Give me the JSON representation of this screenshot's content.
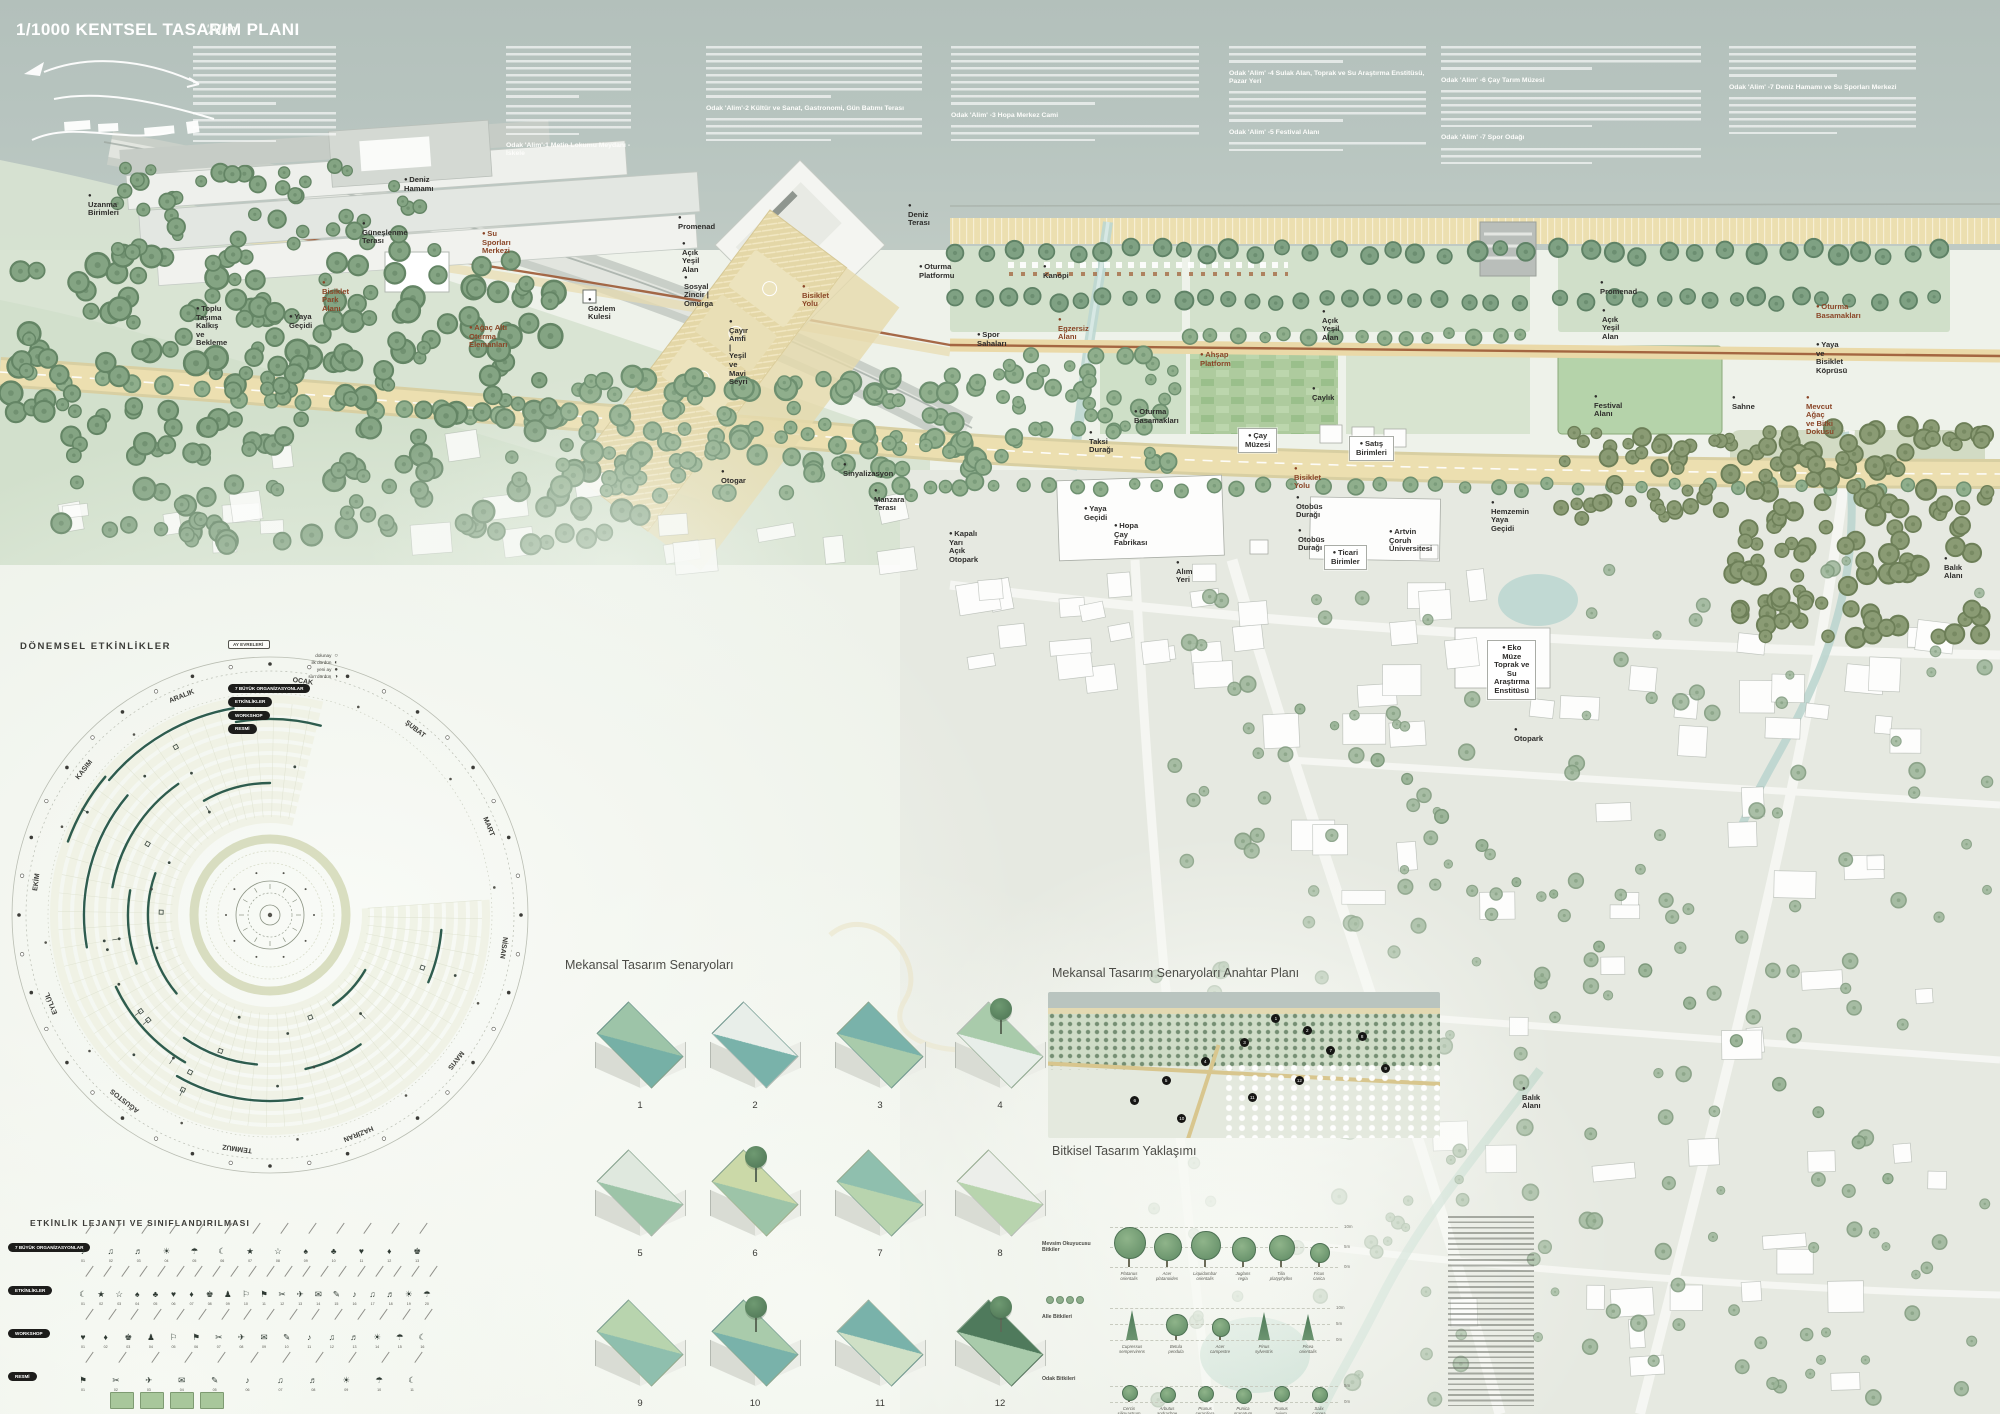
{
  "header": {
    "title": "1/1000 KENTSEL TASARIM PLANI",
    "subtitle": "'Alim'",
    "columns": [
      {
        "x": 207,
        "w": 143,
        "segments": [
          [
            "p",
            8
          ],
          [
            "p",
            4
          ]
        ]
      },
      {
        "x": 520,
        "w": 125,
        "segments": [
          [
            "p",
            7
          ],
          [
            "p",
            4
          ],
          [
            "h",
            "Odak 'Alim'-1 Metin Lokumu Meydanı - İskele"
          ]
        ]
      },
      {
        "x": 720,
        "w": 216,
        "segments": [
          [
            "p",
            7
          ],
          [
            "h",
            "Odak 'Alim'-2 Kültür ve Sanat, Gastronomi, Gün Batımı Terası"
          ],
          [
            "p",
            3
          ]
        ]
      },
      {
        "x": 965,
        "w": 248,
        "segments": [
          [
            "p",
            8
          ],
          [
            "h",
            "Odak 'Alim' -3 Hopa Merkez Cami"
          ],
          [
            "p",
            2
          ]
        ]
      },
      {
        "x": 1243,
        "w": 197,
        "segments": [
          [
            "p",
            2
          ],
          [
            "h",
            "Odak 'Alim' -4 Sulak Alan, Toprak ve Su Araştırma Enstitüsü, Pazar Yeri"
          ],
          [
            "p",
            4
          ],
          [
            "h",
            "Odak 'Alim' -5 Festival Alanı"
          ],
          [
            "p",
            1
          ]
        ]
      },
      {
        "x": 1455,
        "w": 260,
        "segments": [
          [
            "p",
            3
          ],
          [
            "h",
            "Odak 'Alim' -6 Çay Tarım Müzesi"
          ],
          [
            "p",
            5
          ],
          [
            "h",
            "Odak 'Alim' -7 Spor Odağı"
          ],
          [
            "p",
            2
          ]
        ]
      },
      {
        "x": 1743,
        "w": 187,
        "segments": [
          [
            "p",
            4
          ],
          [
            "h",
            "Odak 'Alim' -7 Deniz Hamamı ve Su Sporları Merkezi"
          ],
          [
            "p",
            5
          ]
        ]
      }
    ]
  },
  "map": {
    "labels": [
      {
        "t": "Deniz Hamamı",
        "x": 404,
        "y": 176
      },
      {
        "t": "Güneşlenme Terası",
        "x": 362,
        "y": 220
      },
      {
        "t": "Su Sporları Merkezi",
        "x": 482,
        "y": 230,
        "c": "b"
      },
      {
        "t": "Uzanma Birimleri",
        "x": 88,
        "y": 192
      },
      {
        "t": "Toplu Taşıma\nKalkış ve Bekleme",
        "x": 196,
        "y": 305
      },
      {
        "t": "Yaya\nGeçidi",
        "x": 289,
        "y": 313
      },
      {
        "t": "Bisiklet\nPark Alanı",
        "x": 322,
        "y": 279,
        "c": "b"
      },
      {
        "t": "Gözlem Kulesi",
        "x": 588,
        "y": 296
      },
      {
        "t": "Promenad",
        "x": 678,
        "y": 214
      },
      {
        "t": "Açık Yeşil Alan",
        "x": 682,
        "y": 240
      },
      {
        "t": "Sosyal Zincir | Omurga",
        "x": 684,
        "y": 274
      },
      {
        "t": "Bisiklet Yolu",
        "x": 802,
        "y": 283,
        "c": "b"
      },
      {
        "t": "Çayır Amfi | Yeşil ve Mavi Seyri",
        "x": 729,
        "y": 318
      },
      {
        "t": "Ağaç Altı Oturma Elemanları",
        "x": 469,
        "y": 324,
        "c": "b"
      },
      {
        "t": "Deniz Terası",
        "x": 908,
        "y": 202
      },
      {
        "t": "Oturma Platformu",
        "x": 919,
        "y": 263
      },
      {
        "t": "Kanopi",
        "x": 1043,
        "y": 263
      },
      {
        "t": "Egzersiz Alanı",
        "x": 1058,
        "y": 316,
        "c": "b"
      },
      {
        "t": "Spor Sahaları",
        "x": 977,
        "y": 331
      },
      {
        "t": "Ahşap Platform",
        "x": 1200,
        "y": 351,
        "c": "b"
      },
      {
        "t": "Oturma\nBasamakları",
        "x": 1134,
        "y": 408
      },
      {
        "t": "Açık Yeşil Alan",
        "x": 1322,
        "y": 308
      },
      {
        "t": "Çaylık",
        "x": 1312,
        "y": 385
      },
      {
        "t": "Promenad",
        "x": 1600,
        "y": 279
      },
      {
        "t": "Açık Yeşil Alan",
        "x": 1602,
        "y": 307
      },
      {
        "t": "Festival Alanı",
        "x": 1594,
        "y": 393
      },
      {
        "t": "Oturma Basamakları",
        "x": 1816,
        "y": 303,
        "c": "b"
      },
      {
        "t": "Yaya ve Bisiklet\nKöprüsü",
        "x": 1816,
        "y": 341
      },
      {
        "t": "Sahne",
        "x": 1732,
        "y": 394
      },
      {
        "t": "Mevcut Ağaç ve Bitki Dokusu",
        "x": 1806,
        "y": 394,
        "c": "b"
      },
      {
        "t": "Bisiklet Yolu",
        "x": 1294,
        "y": 465,
        "c": "b"
      },
      {
        "t": "Otobüs Durağı",
        "x": 1296,
        "y": 494
      },
      {
        "t": "Otobüs Durağı",
        "x": 1298,
        "y": 527
      },
      {
        "t": "Hemzemin\nYaya Geçidi",
        "x": 1491,
        "y": 499
      },
      {
        "t": "Ticari Birimler",
        "x": 1324,
        "y": 545,
        "box": 1
      },
      {
        "t": "Çay Müzesi",
        "x": 1238,
        "y": 428,
        "box": 1
      },
      {
        "t": "Satış Birimleri",
        "x": 1349,
        "y": 436,
        "box": 1
      },
      {
        "t": "Otogar",
        "x": 721,
        "y": 468
      },
      {
        "t": "Sinyalizasyon",
        "x": 843,
        "y": 461
      },
      {
        "t": "Yaya\nGeçidi",
        "x": 1084,
        "y": 505
      },
      {
        "t": "Kapalı Yarı\nAçık Otopark",
        "x": 949,
        "y": 530
      },
      {
        "t": "Alım Yeri",
        "x": 1176,
        "y": 559
      },
      {
        "t": "Hopa Çay Fabrikası",
        "x": 1114,
        "y": 522
      },
      {
        "t": "Artvin Çoruh Üniversitesi",
        "x": 1389,
        "y": 528
      },
      {
        "t": "Balık Alanı",
        "x": 1944,
        "y": 555
      },
      {
        "t": "Eko Müze\nToprak ve Su\nAraştırma Enstitüsü",
        "x": 1487,
        "y": 640,
        "box": 1
      },
      {
        "t": "Otopark",
        "x": 1514,
        "y": 726
      },
      {
        "t": "Manzara Terası",
        "x": 874,
        "y": 487
      },
      {
        "t": "Taksi Durağı",
        "x": 1089,
        "y": 429
      },
      {
        "t": "Balık Alanı",
        "x": 1522,
        "y": 1085
      }
    ]
  },
  "calendar": {
    "title": "DÖNEMSEL ETKİNLİKLER",
    "months": [
      "OCAK",
      "ŞUBAT",
      "MART",
      "NİSAN",
      "MAYIS",
      "HAZİRAN",
      "TEMMUZ",
      "AĞUSTOS",
      "EYLÜL",
      "EKİM",
      "KASIM",
      "ARALIK"
    ],
    "moon_title": "AY EVRELERİ",
    "moons": [
      {
        "label": "dolunay",
        "g": "○"
      },
      {
        "label": "ilk dördün",
        "g": "◐"
      },
      {
        "label": "yeni ay",
        "g": "●"
      },
      {
        "label": "son dördün",
        "g": "◑"
      }
    ],
    "pills": [
      "7 BÜYÜK ORGANİZASYONLAR",
      "ETKİNLİKLER",
      "WORKSHOP",
      "RESMİ"
    ]
  },
  "lejant": {
    "title": "ETKİNLİK LEJANTI VE SINIFLANDIRILMASI",
    "rows": [
      {
        "label": "7 BÜYÜK ORGANİZASYONLAR",
        "count": 13
      },
      {
        "label": "ETKİNLİKLER",
        "count": 20
      },
      {
        "label": "WORKSHOP",
        "count": 16
      },
      {
        "label": "RESMİ",
        "count": 11
      }
    ]
  },
  "scenarios": {
    "title": "Mekansal Tasarım Senaryoları",
    "items": [
      {
        "num": "1",
        "a": "#9dc4a8",
        "b": "#76b0a6",
        "tree": false
      },
      {
        "num": "2",
        "a": "#e8eee9",
        "b": "#79b2aa",
        "tree": false
      },
      {
        "num": "3",
        "a": "#79b2aa",
        "b": "#a9cbab",
        "tree": false
      },
      {
        "num": "4",
        "a": "#a9cbab",
        "b": "#e8eee9",
        "tree": true
      },
      {
        "num": "5",
        "a": "#dfe8de",
        "b": "#9dc4a8",
        "tree": false
      },
      {
        "num": "6",
        "a": "#cbd9a8",
        "b": "#9dc4a8",
        "tree": true
      },
      {
        "num": "7",
        "a": "#8fbfae",
        "b": "#b8d4ae",
        "tree": false
      },
      {
        "num": "8",
        "a": "#eceeea",
        "b": "#b8d4ae",
        "tree": false
      },
      {
        "num": "9",
        "a": "#b8d4ae",
        "b": "#8fbfae",
        "tree": false
      },
      {
        "num": "10",
        "a": "#a9cbab",
        "b": "#79b2aa",
        "tree": true
      },
      {
        "num": "11",
        "a": "#79b2aa",
        "b": "#cfe0c6",
        "tree": false
      },
      {
        "num": "12",
        "a": "#4f7a5c",
        "b": "#a9cbab",
        "tree": true
      }
    ]
  },
  "keyplan": {
    "title": "Mekansal Tasarım Senaryoları Anahtar Planı",
    "markers": [
      {
        "n": "1",
        "x": 58,
        "y": 18
      },
      {
        "n": "2",
        "x": 66,
        "y": 26
      },
      {
        "n": "3",
        "x": 50,
        "y": 34
      },
      {
        "n": "4",
        "x": 40,
        "y": 47
      },
      {
        "n": "5",
        "x": 30,
        "y": 60
      },
      {
        "n": "6",
        "x": 22,
        "y": 74
      },
      {
        "n": "7",
        "x": 72,
        "y": 40
      },
      {
        "n": "8",
        "x": 80,
        "y": 30
      },
      {
        "n": "9",
        "x": 86,
        "y": 52
      },
      {
        "n": "10",
        "x": 34,
        "y": 86
      },
      {
        "n": "11",
        "x": 52,
        "y": 72
      },
      {
        "n": "12",
        "x": 64,
        "y": 60
      }
    ]
  },
  "planting": {
    "title": "Bitkisel Tasarım Yaklaşımı",
    "groups": [
      {
        "label": "Mevsim Okuyucusu Bitkiler",
        "scale": [
          "10m",
          "5m",
          "0m"
        ],
        "species": [
          [
            "Platanus orientalis",
            "d",
            40
          ],
          [
            "Acer platanoides",
            "d",
            34
          ],
          [
            "Liquidambar orientalis",
            "d",
            36
          ],
          [
            "Juglans regia",
            "d",
            30
          ],
          [
            "Tilia platyphyllos",
            "d",
            32
          ],
          [
            "Ficus carica",
            "d",
            24
          ]
        ]
      },
      {
        "label": "Alle Bitkileri",
        "scale": [
          "10m",
          "5m",
          "0m"
        ],
        "species": [
          [
            "Cupressus sempervirens",
            "c",
            30
          ],
          [
            "Betula pendula",
            "d",
            26
          ],
          [
            "Acer campestre",
            "d",
            22
          ],
          [
            "Pinus sylvestris",
            "c",
            28
          ],
          [
            "Picea orientalis",
            "c",
            26
          ]
        ]
      },
      {
        "label": "Odak Bitkileri",
        "scale": [
          "5m",
          "0m"
        ],
        "species": [
          [
            "Cercis siliquastrum",
            "d",
            17
          ],
          [
            "Arbutus andrachne",
            "d",
            15
          ],
          [
            "Prunus ceracifera",
            "d",
            16
          ],
          [
            "Punica granatum",
            "d",
            14
          ],
          [
            "Prunus avium",
            "d",
            16
          ],
          [
            "Salix caprea",
            "d",
            15
          ]
        ]
      }
    ]
  },
  "colors": {
    "sea": "#b6c3be",
    "road": "#ecdfb0",
    "brown": "#9c5935",
    "ink": "#2e2d2b",
    "pine": "#2e5c4e",
    "lawn": "#b5d3aa"
  }
}
